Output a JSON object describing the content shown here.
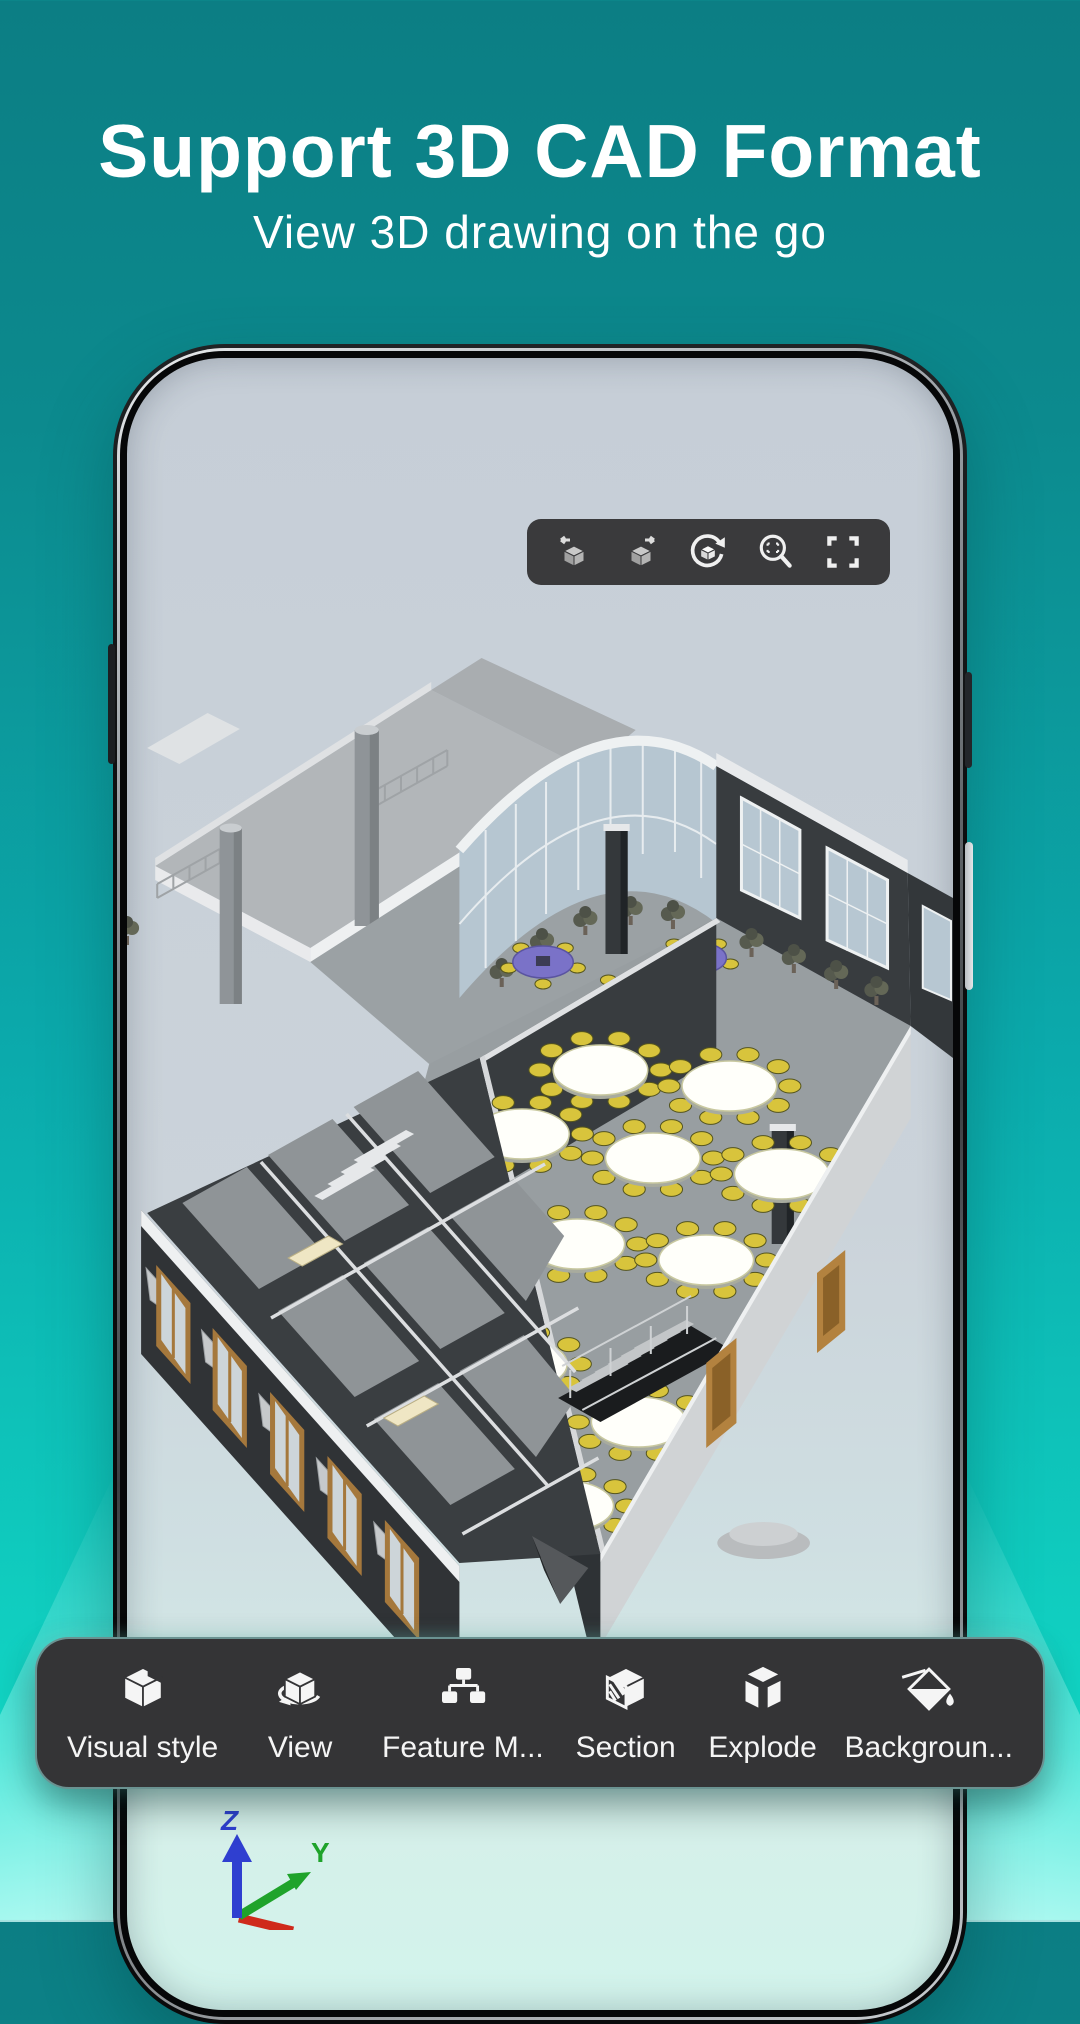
{
  "header": {
    "title": "Support 3D CAD Format",
    "subtitle": "View 3D drawing on the go"
  },
  "phone": {
    "viewer_toolbar": {
      "icons": [
        {
          "name": "previous-view-icon"
        },
        {
          "name": "next-view-icon"
        },
        {
          "name": "orbit-view-icon"
        },
        {
          "name": "zoom-window-icon"
        },
        {
          "name": "fullscreen-icon"
        }
      ]
    },
    "axis_indicator": {
      "z_label": "Z",
      "y_label": "Y",
      "z_color": "#2f3fd0",
      "y_color": "#1fa32b",
      "x_color": "#cf2a1b"
    }
  },
  "bottom_toolbar": {
    "items": [
      {
        "icon": "visual-style-icon",
        "label": "Visual style"
      },
      {
        "icon": "view-icon",
        "label": "View"
      },
      {
        "icon": "feature-manager-icon",
        "label": "Feature M..."
      },
      {
        "icon": "section-icon",
        "label": "Section"
      },
      {
        "icon": "explode-icon",
        "label": "Explode"
      },
      {
        "icon": "background-icon",
        "label": "Backgroun..."
      }
    ]
  },
  "colors": {
    "background_top": "#0c7e84",
    "background_bottom": "#14e0ca",
    "toolbar_background": "#343436",
    "toolbar_glow": "#8ef2e8",
    "screen_background": "#cbd3da",
    "model_wall_dark": "#35393c",
    "model_floor_gray": "#999fa2",
    "model_table_white": "#fffffa",
    "model_chair_yellow": "#d8c43c",
    "model_purple_table": "#7a72c8",
    "model_window_tan": "#a5783c",
    "model_glass_blue": "#b6c6d1"
  }
}
